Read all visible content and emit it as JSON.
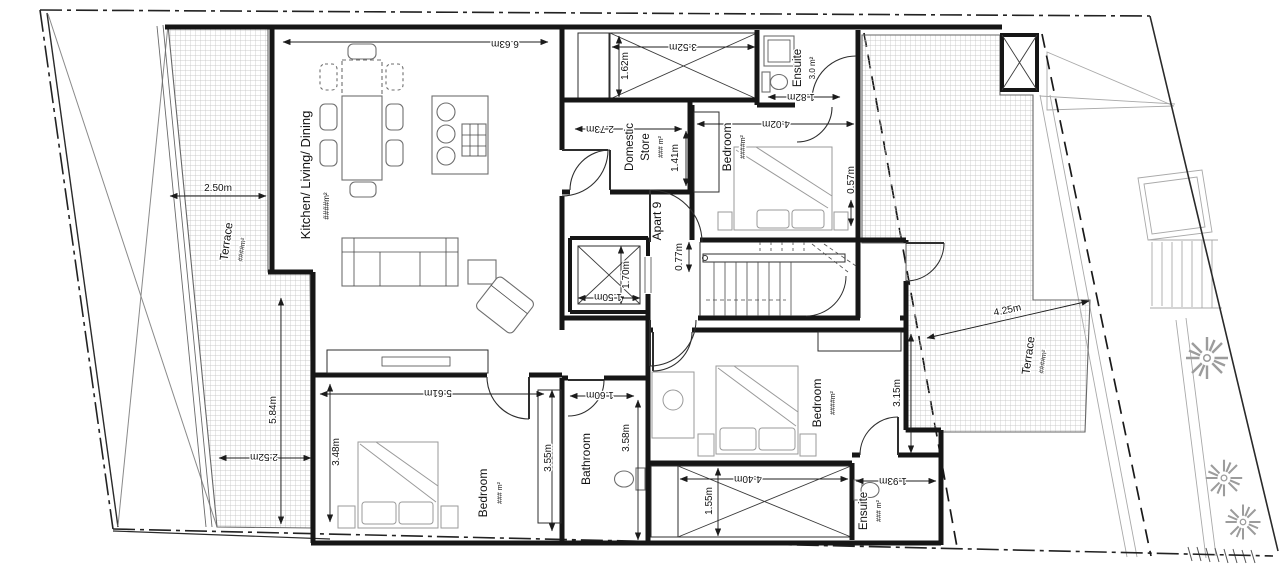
{
  "plan": {
    "rooms": {
      "kitchen": {
        "name": "Kitchen/ Living/ Dining",
        "area": "####m²"
      },
      "terrace_left": {
        "name": "Terrace",
        "area": "####m²"
      },
      "domestic_store": {
        "line1": "Domestic",
        "line2": "Store",
        "area": "### m²"
      },
      "ensuite_top": {
        "name": "Ensuite",
        "area": "3.0 m²"
      },
      "bedroom_top": {
        "name": "Bedroom",
        "area": "####m²"
      },
      "terrace_right": {
        "name": "Terrace",
        "area": "####m²"
      },
      "apart": {
        "label": "Apart 9"
      },
      "bedroom_left": {
        "name": "Bedroom",
        "area": "### m²"
      },
      "bathroom": {
        "name": "Bathroom"
      },
      "bedroom_right": {
        "name": "Bedroom",
        "area": "####m²"
      },
      "ensuite_bottom": {
        "name": "Ensuite",
        "area": "### m²"
      }
    },
    "dims": {
      "kitchen_top": "6.63m",
      "terrace_left_top": "2.50m",
      "terrace_left_bottom": "2.52m",
      "terrace_left_length": "5.84m",
      "void_top_w": "3.52m",
      "void_top_d": "1.62m",
      "store_w": "2.73m",
      "store_d": "1.41m",
      "ensuite_top_w": "1.82m",
      "bed_top_w": "4.02m",
      "bed_top_gap": "0.57m",
      "lift_d": "1.70m",
      "lift_w": "1.50m",
      "hall": "0.77m",
      "terrace_right_w": "4.25m",
      "bed_right_d": "3.15m",
      "bed_left_w": "5.61m",
      "bed_left_d": "3.48m",
      "bed_left_d2": "3.55m",
      "bath_w": "1.60m",
      "bath_d": "3.58m",
      "void_bot_w": "4.40m",
      "void_bot_d": "1.55m",
      "ensuite_bot_w": "1.93m"
    },
    "palette": {
      "wall": "#161616",
      "dimension": "#1c1c1c",
      "terrace_hatch": "#bdbdbd",
      "neighbor_lines": "#a9a9a9",
      "furniture": "#6e6e6e",
      "background": "#ffffff"
    }
  }
}
